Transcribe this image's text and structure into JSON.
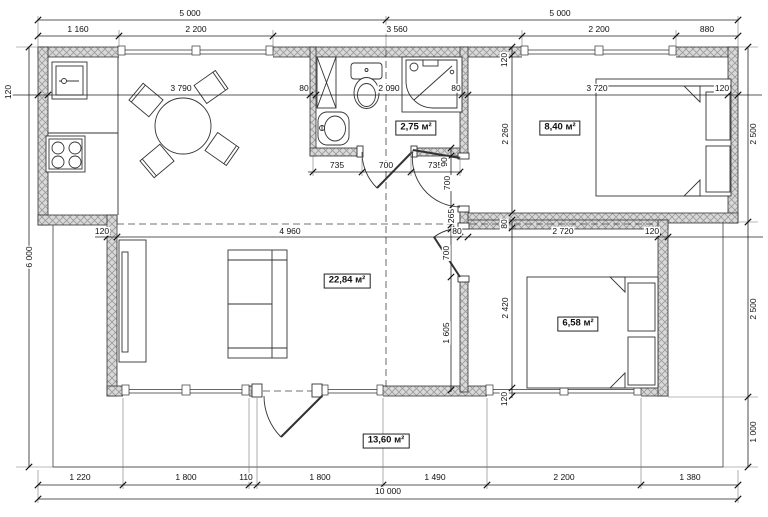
{
  "colors": {
    "wall_fill": "#d9d9d9",
    "wall_hatch": "#9a9a9a",
    "line": "#1a1a1a"
  },
  "rooms": {
    "bathroom": {
      "label": "2,75 м²"
    },
    "bedroom1": {
      "label": "8,40 м²"
    },
    "living": {
      "label": "22,84 м²"
    },
    "bedroom2": {
      "label": "6,58 м²"
    },
    "terrace": {
      "label": "13,60 м²"
    }
  },
  "dims": {
    "d5000_left": "5 000",
    "d5000_right": "5 000",
    "d1160": "1 160",
    "d2200_top_left": "2 200",
    "d3560": "3 560",
    "d2200_top_right": "2 200",
    "d880": "880",
    "d120_wall_left": "120",
    "d3790": "3 790",
    "d80_bath_left": "80",
    "d2090": "2 090",
    "d80_bath_right": "80",
    "d3720": "3 720",
    "d120_wall_right": "120",
    "d735_left": "735",
    "d700_bath_door": "700",
    "d735_right": "735",
    "d90": "90",
    "d700_bed1_door": "700",
    "d265": "265",
    "d80_hall_wall": "80",
    "d700_bed2_door": "700",
    "d1605": "1 605",
    "d120_living_wall": "120",
    "d4960": "4 960",
    "d2720": "2 720",
    "d120_bed2_wall": "120",
    "d120_top_wall": "120",
    "d2260": "2 260",
    "d80_bed2_top_wall": "80",
    "d2420": "2 420",
    "d120_bed2_bottom_wall": "120",
    "d6000": "6 000",
    "d2500_upper": "2 500",
    "d2500_lower": "2 500",
    "d1000": "1 000",
    "d1220": "1 220",
    "d1800_left": "1 800",
    "d110": "110",
    "d1800_center": "1 800",
    "d1490": "1 490",
    "d2200_bottom": "2 200",
    "d1380": "1 380",
    "d10000": "10 000"
  }
}
